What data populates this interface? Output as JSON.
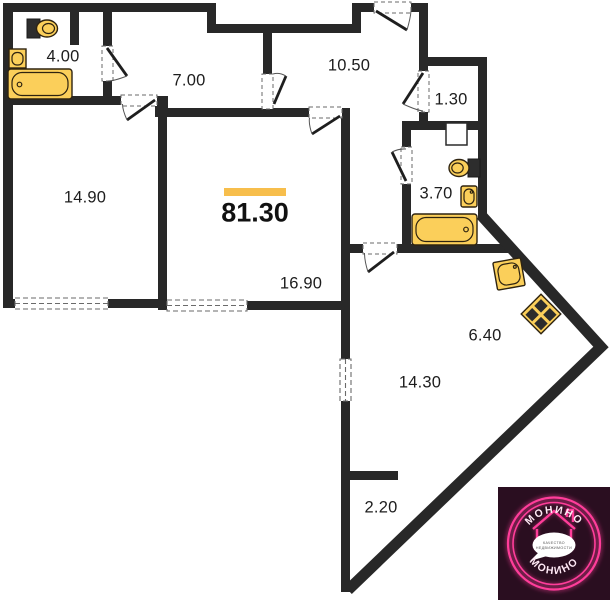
{
  "plan": {
    "total_area": "81.30",
    "rooms": [
      {
        "name": "bathroom-top-left",
        "area": "4.00"
      },
      {
        "name": "hall-inner",
        "area": "7.00"
      },
      {
        "name": "entrance-hall",
        "area": "10.50"
      },
      {
        "name": "storage-closet",
        "area": "1.30"
      },
      {
        "name": "bathroom-right",
        "area": "3.70"
      },
      {
        "name": "room-left",
        "area": "14.90"
      },
      {
        "name": "room-center",
        "area": "16.90"
      },
      {
        "name": "kitchen-zone",
        "area": "6.40"
      },
      {
        "name": "living-zone",
        "area": "14.30"
      },
      {
        "name": "niche",
        "area": "2.20"
      }
    ],
    "fixtures": [
      "toilet",
      "washbasin",
      "bathtub",
      "toilet",
      "washbasin",
      "bathtub",
      "kitchen-sink",
      "stove"
    ],
    "colors": {
      "walls": "#282828",
      "accent": "#F7BE4C",
      "fixtures": "#FBCF5A"
    }
  },
  "logo": {
    "brand_top": "МОНИНО",
    "brand_bottom": "МОНИНО",
    "tagline_line1": "КАЧЕСТВО",
    "tagline_line2": "НЕДВИЖИМОСТИ",
    "colors": {
      "background": "#2A0E20",
      "neon": "#FF3D9A"
    }
  }
}
